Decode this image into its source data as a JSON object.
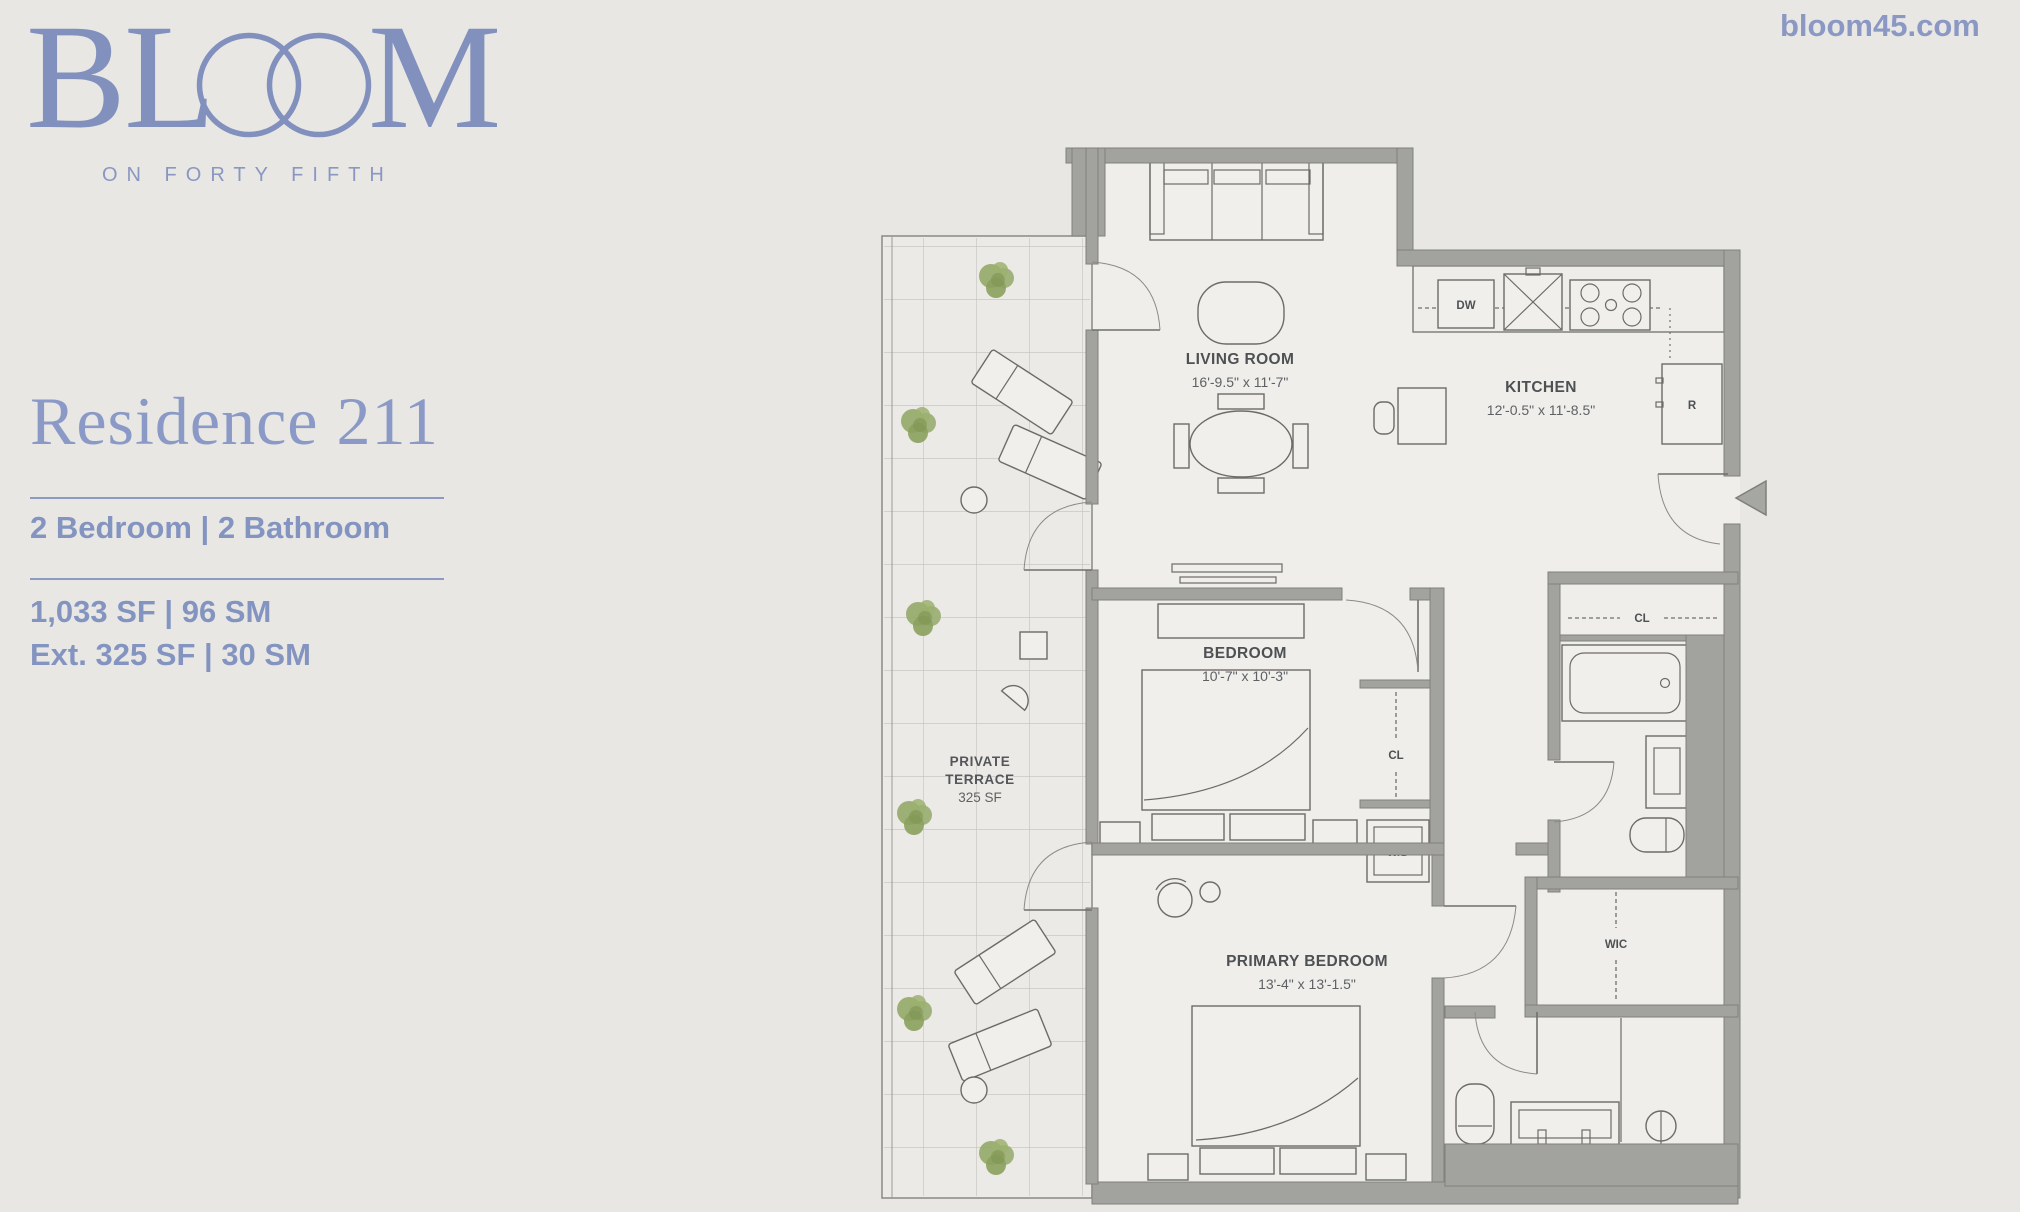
{
  "page": {
    "background": "#e8e7e4",
    "accent_blue": "#8494c0"
  },
  "brand": {
    "logo_bl": "BL",
    "logo_m": "M",
    "tagline": "ON FORTY FIFTH",
    "website": "bloom45.com"
  },
  "residence": {
    "title": "Residence 211",
    "config": "2 Bedroom | 2 Bathroom",
    "area": "1,033 SF | 96 SM",
    "area_ext": "Ext. 325 SF | 30 SM"
  },
  "floor_plan": {
    "living": {
      "name": "LIVING ROOM",
      "dims": "16'-9.5\" x 11'-7\""
    },
    "kitchen": {
      "name": "KITCHEN",
      "dims": "12'-0.5\" x 11'-8.5\""
    },
    "bedroom": {
      "name": "BEDROOM",
      "dims": "10'-7\" x 10'-3\""
    },
    "primary_bedroom": {
      "name": "PRIMARY BEDROOM",
      "dims": "13'-4\" x 13'-1.5\""
    },
    "terrace": {
      "name_line1": "PRIVATE",
      "name_line2": "TERRACE",
      "area": "325 SF"
    },
    "labels": {
      "closet": "CL",
      "walk_in_closet": "WIC",
      "washer_dryer": "W/D",
      "dishwasher": "DW",
      "refrigerator": "R"
    }
  }
}
